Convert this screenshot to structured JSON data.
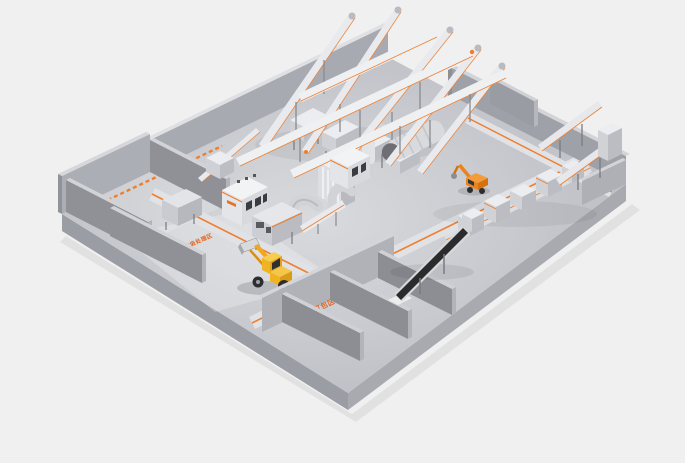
{
  "scene": {
    "kind": "isometric-3d-render",
    "subject": "waste sorting / recycling plant equipment layout on a raised gray platform",
    "background_color": "#f0f0f1",
    "accent_color": "#ee7e2e",
    "floor_color": "#c6c8cd",
    "wall_color": "#9a9ca3",
    "machine_color": "#e9eaed",
    "belt_dark_color": "#2b2b2e",
    "loader_color": "#f0b324",
    "handler_color": "#e8831f",
    "floor_labels": {
      "zone1_line1": "建筑装修垃圾处理区",
      "zone1_line2": "堆放区",
      "zone2": "多种物料打包区"
    },
    "objects": {
      "wheel_loader": "yellow wheel loader with raised bucket",
      "material_handler": "orange material handler with grab arm",
      "conveyor_fan": "fan of inclined conveyors rising over the back wall",
      "cross_conveyors": "long transfer conveyors crossing the hall",
      "black_conveyor": "dark inclined feed conveyor in baling area",
      "storage_bays": "open walled storage bunkers",
      "roads": "orange-marked transport lanes on the floor"
    }
  }
}
